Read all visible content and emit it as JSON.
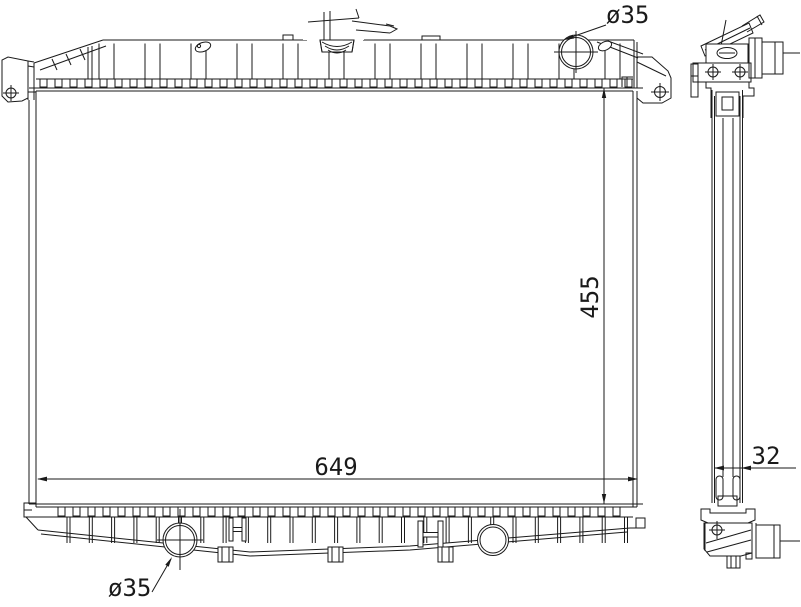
{
  "drawing": {
    "labels": {
      "top_port_diameter": "ø35",
      "core_height": "455",
      "core_width": "649",
      "core_thickness": "32",
      "bottom_port_diameter": "ø35"
    },
    "colors": {
      "line": "#1a1a1a",
      "background": "#ffffff"
    }
  }
}
